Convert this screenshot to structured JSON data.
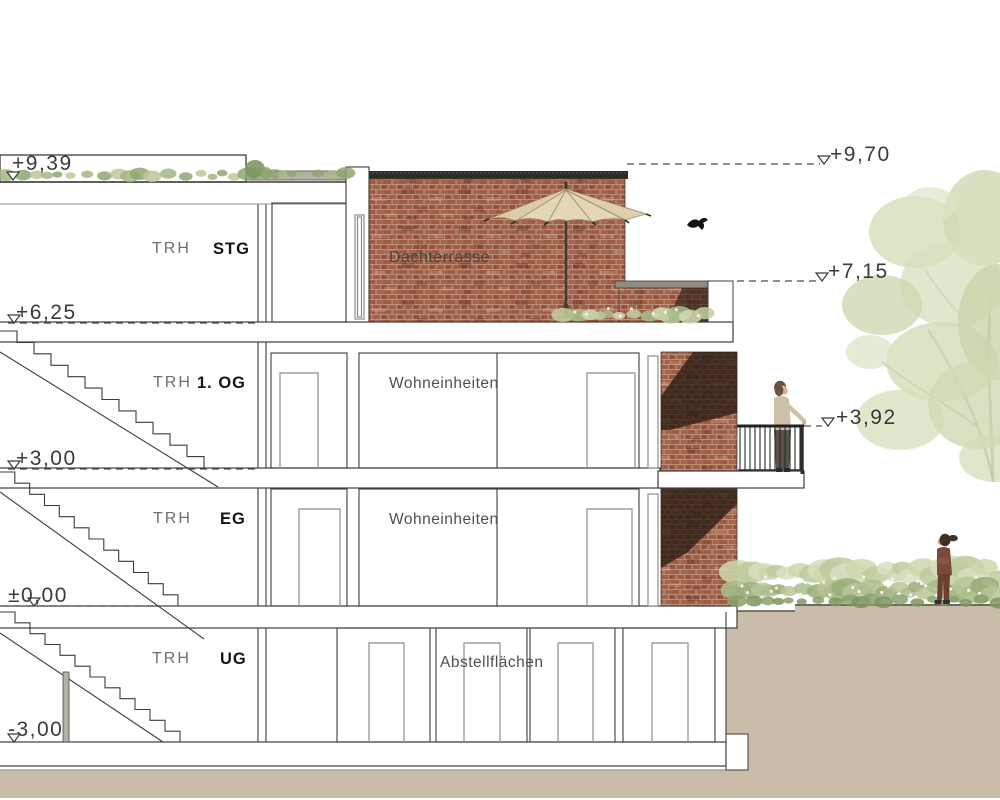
{
  "levels": {
    "trh_roof": "+9,39",
    "terrace_wall_top": "+9,70",
    "upper_roof": "+7,15",
    "stg_floor": "+6,25",
    "balcony_railing": "+3,92",
    "og1_floor": "+3,00",
    "eg_floor": "±0,00",
    "ug_floor": "-3,00"
  },
  "floors": {
    "stg": {
      "stairwell": "TRH",
      "code": "STG"
    },
    "og1": {
      "stairwell": "TRH",
      "code": "1. OG"
    },
    "eg": {
      "stairwell": "TRH",
      "code": "EG"
    },
    "ug": {
      "stairwell": "TRH",
      "code": "UG"
    }
  },
  "rooms": {
    "roof_terrace": "Dachterrasse",
    "og1_units": "Wohneinheiten",
    "eg_units": "Wohneinheiten",
    "ug_storage": "Abstellflächen"
  },
  "colors": {
    "brick": "#9d5c46",
    "mortar": "#bd9078",
    "ground": "#c9bdaa",
    "foliage": "#c9d8ab",
    "umbrella": "#e3d7b7",
    "line": "#3f3c38"
  }
}
